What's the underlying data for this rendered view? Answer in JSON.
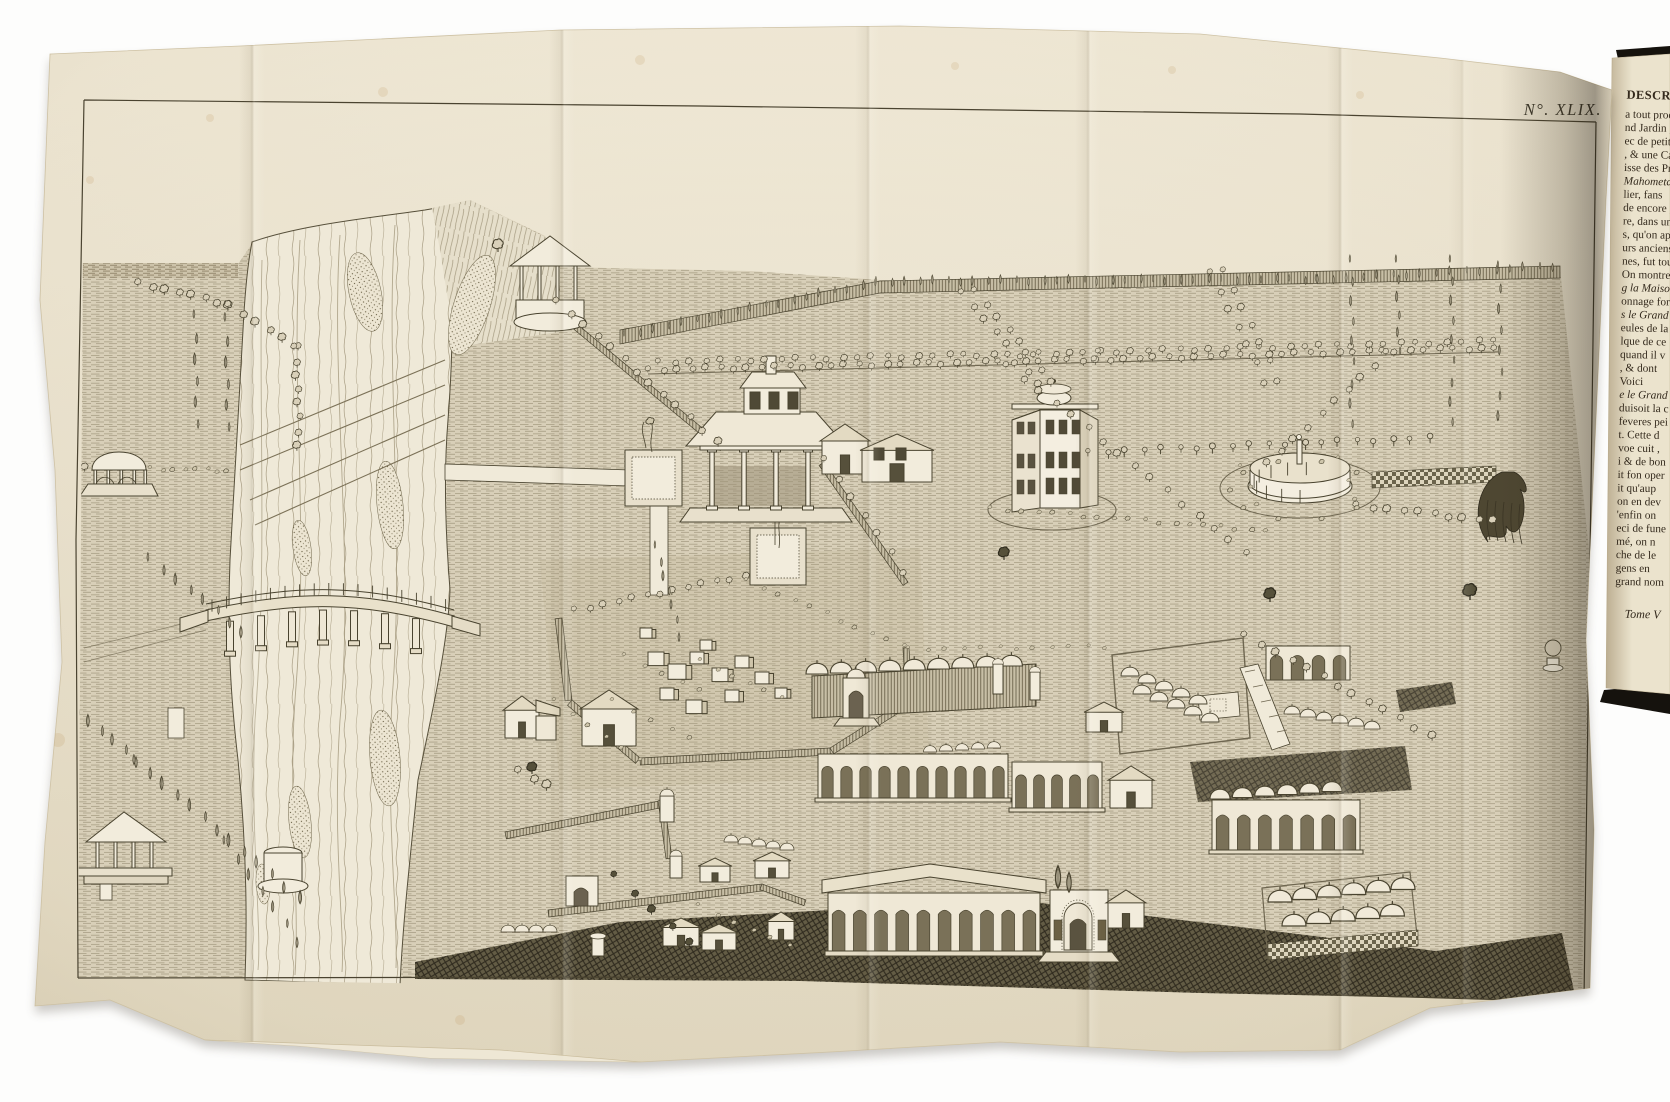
{
  "photo": {
    "background": "#fdfdfc",
    "description": "Antique book opened to a large engraved fold-out plate: bird's-eye view of walled Persian gardens along a river"
  },
  "plate": {
    "number": "N°. XLIX.",
    "paper_color": "#e9e1cd",
    "ink_color": "#4a4330",
    "features": [
      "river",
      "weirs",
      "bridge-on-piers",
      "riverside-kiosk",
      "domed-gazebo",
      "hip-roof-gazebo",
      "tree-avenues",
      "garden-walls",
      "columned-pavilion",
      "fountain-basins",
      "water-channel",
      "octagonal-mansion",
      "round-colonnade",
      "checker-path",
      "walled-cemetery",
      "domed-caravanserai",
      "arcaded-walls",
      "dome-courtyards",
      "arcade-pavilion",
      "gateway",
      "small-houses",
      "plowed-fields",
      "weeping-willow",
      "potted-tree",
      "round-platform"
    ]
  },
  "book_page": {
    "heading": "DESCRITPI",
    "lines": [
      "a tout proc",
      "nd Jardin ,",
      "ec de petits",
      ", & une Ca",
      "isse des Prie",
      "Mahometanes",
      "lier, fans",
      "de encore ,",
      "re, dans un",
      "s, qu'on ap",
      "urs anciens",
      "nes, fut tou",
      "On montre po",
      "g la Maison",
      "onnage fort",
      "s le Grand",
      "eules de la",
      "lque de ce",
      "quand il v",
      ", & dont",
      "Voici",
      "e le Grand",
      "duisoit la c",
      "feveres pei",
      "t. Cette d",
      "voe cuit ,",
      "i & de bon",
      "it fon oper",
      "it qu'aup",
      "on en dev",
      "'enfin on",
      "eci de fune",
      "mé, on n",
      "che de le",
      "gens en",
      "grand nom"
    ],
    "italic_line_indexes": [
      5,
      13,
      15,
      21
    ],
    "signature": "Tome V"
  }
}
